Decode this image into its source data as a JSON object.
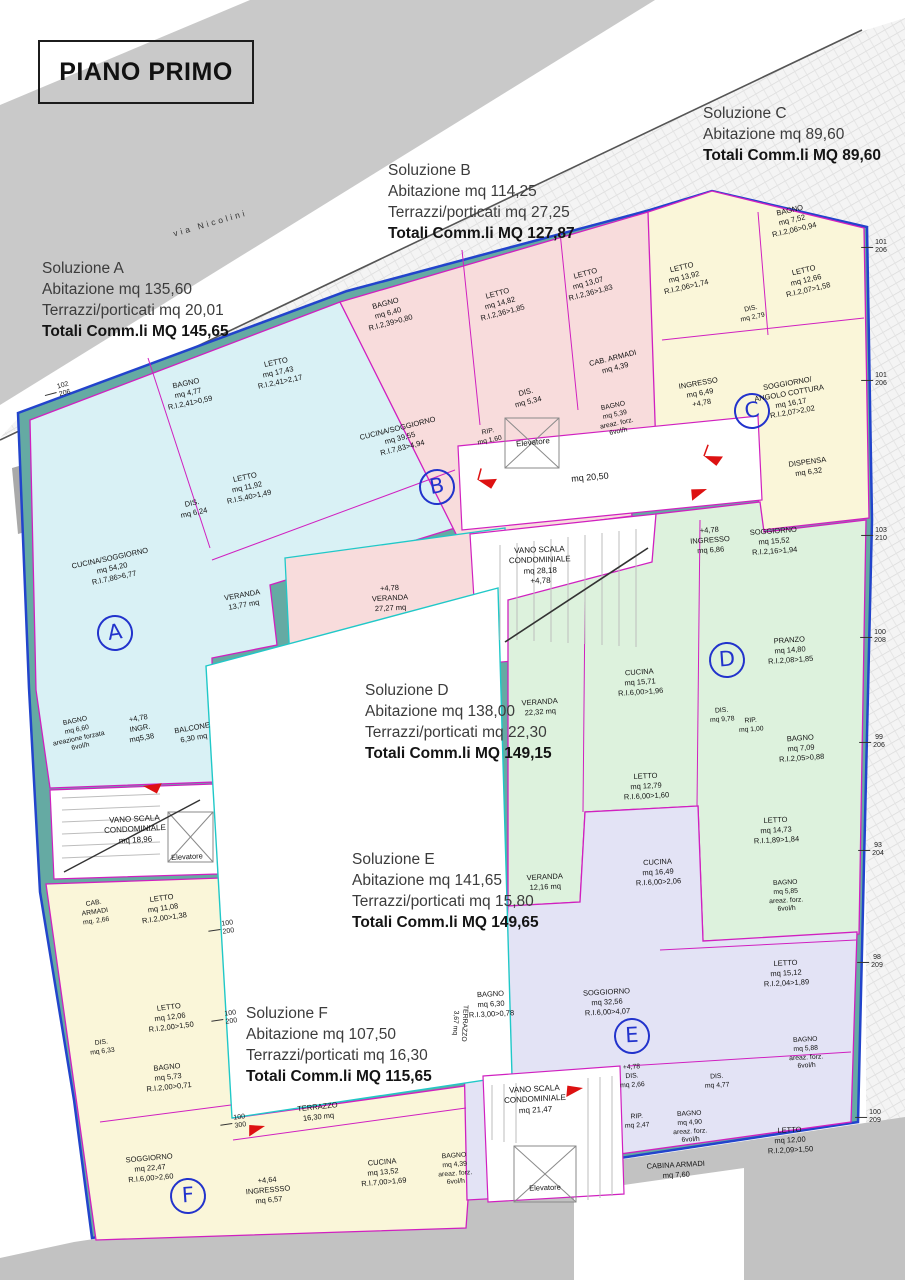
{
  "title": "PIANO PRIMO",
  "street_label": "via Nicolini",
  "solutions": [
    {
      "id": "A",
      "name": "Soluzione A",
      "abitazione": "Abitazione mq 135,60",
      "terrazzi": "Terrazzi/porticati mq 20,01",
      "totale": "Totali Comm.li MQ 145,65"
    },
    {
      "id": "B",
      "name": "Soluzione B",
      "abitazione": "Abitazione mq 114,25",
      "terrazzi": "Terrazzi/porticati mq 27,25",
      "totale": "Totali Comm.li MQ 127,87"
    },
    {
      "id": "C",
      "name": "Soluzione C",
      "abitazione": "Abitazione mq 89,60",
      "terrazzi": "",
      "totale": "Totali Comm.li MQ 89,60"
    },
    {
      "id": "D",
      "name": "Soluzione D",
      "abitazione": "Abitazione mq 138,00",
      "terrazzi": "Terrazzi/porticati mq 22,30",
      "totale": "Totali Comm.li MQ 149,15"
    },
    {
      "id": "E",
      "name": "Soluzione E",
      "abitazione": "Abitazione mq 141,65",
      "terrazzi": "Terrazzi/porticati mq 15,80",
      "totale": "Totali Comm.li MQ 149,65"
    },
    {
      "id": "F",
      "name": "Soluzione F",
      "abitazione": "Abitazione mq 107,50",
      "terrazzi": "Terrazzi/porticati mq 16,30",
      "totale": "Totali Comm.li MQ 115,65"
    }
  ],
  "units": {
    "A": {
      "badge": "A",
      "rooms": {
        "bagno1": "BAGNO\nmq 4,77\nR.I.2,41>0,59",
        "letto1": "LETTO\nmq 17,43\nR.I.2,41>2,17",
        "letto2": "LETTO\nmq 11,92\nR.I.5,40>1,49",
        "dis": "DIS.\nmq 6,24",
        "cucina_soggiorno": "CUCINA/SOGGIORNO\nmq 54,20\nR.I.7,86>6,77",
        "veranda": "VERANDA\n13,77 mq",
        "bagno2": "BAGNO\nmq 6,60\nareazione forzata\n6vol/h",
        "ingresso": "+4,78\nINGR.\nmq5,38",
        "balcone": "BALCONE\n6,30 mq"
      }
    },
    "B": {
      "badge": "B",
      "rooms": {
        "bagno1": "BAGNO\nmq 6,40\nR.I.2,39>0,80",
        "letto1": "LETTO\nmq 14,82\nR.I.2,36>1,85",
        "letto2": "LETTO\nmq 13,07\nR.I.2,36>1,83",
        "cab_armadi": "CAB. ARMADI\nmq 4,39",
        "dis": "DIS.\nmq 5,34",
        "rip": "RIP.\nmq 1,60",
        "bagno2": "BAGNO\nmq 5,39\nareaz. forz.\n6vol/h",
        "cucina_soggiorno": "CUCINA/SOGGIORNO\nmq 39,55\nR.I.7,83>4,94",
        "veranda": "+4,78\nVERANDA\n27,27 mq"
      }
    },
    "C": {
      "badge": "C",
      "rooms": {
        "bagno1": "BAGNO\nmq 7,52\nR.I.2,06>0,94",
        "letto1": "LETTO\nmq 13,92\nR.I.2,06>1,74",
        "letto2": "LETTO\nmq 12,66\nR.I.2,07>1,58",
        "dis": "DIS.\nmq 2,79",
        "ingresso": "INGRESSO\nmq 6,49\n+4,78",
        "soggiorno": "SOGGIORNO/\nANGOLO COTTURA\nmq 16,17\nR.I.2,07>2,02",
        "dispensa": "DISPENSA\nmq 6,32"
      }
    },
    "D": {
      "badge": "D",
      "rooms": {
        "ingresso": "+4,78\nINGRESSO\nmq 6,86",
        "soggiorno": "SOGGIORNO\nmq 15,52\nR.I.2,16>1,94",
        "pranzo": "PRANZO\nmq 14,80\nR.I.2,08>1,85",
        "cucina": "CUCINA\nmq 15,71\nR.I.6,00>1,96",
        "veranda": "VERANDA\n22,32 mq",
        "dis": "DIS.\nmq 9,78",
        "rip": "RIP.\nmq 1,00",
        "bagno1": "BAGNO\nmq 7,09\nR.I.2,05>0,88",
        "letto1": "LETTO\nmq 12,79\nR.I.6,00>1,60",
        "letto2": "LETTO\nmq 14,73\nR.I.1,89>1,84",
        "bagno2": "BAGNO\nmq 5,85\nareaz. forz.\n6vol/h"
      }
    },
    "E": {
      "badge": "E",
      "rooms": {
        "cucina": "CUCINA\nmq 16,49\nR.I.6,00>2,06",
        "veranda": "VERANDA\n12,16 mq",
        "letto1": "LETTO\nmq 15,12\nR.I.2,04>1,89",
        "bagno1": "BAGNO\nmq 6,30\nR.I.3,00>0,78",
        "soggiorno": "SOGGIORNO\nmq 32,56\nR.I.6,00>4,07",
        "terrazzo": "TERRAZZO\n3,67 mq",
        "dis1": "+4,78\nDIS.\nmq 2,66",
        "dis2": "DIS.\nmq 4,77",
        "bagno2": "BAGNO\nmq 5,88\nareaz. forz.\n6vol/h",
        "rip": "RIP.\nmq 2,47",
        "bagno3": "BAGNO\nmq 4,90\nareaz. forz.\n6vol/h",
        "cabina_armadi": "CABINA ARMADI\nmq 7,60",
        "letto2": "LETTO\nmq 12,00\nR.I.2,09>1,50"
      }
    },
    "F": {
      "badge": "F",
      "rooms": {
        "cab_armadi": "CAB.\nARMADI\nmq. 2,66",
        "letto1": "LETTO\nmq 11,08\nR.I.2,00>1,38",
        "letto2": "LETTO\nmq 12,06\nR.I.2,00>1,50",
        "dis": "DIS.\nmq 6,33",
        "bagno1": "BAGNO\nmq 5,73\nR.I.2,00>0,71",
        "soggiorno": "SOGGIORNO\nmq 22,47\nR.I.6,00>2,60",
        "terrazzo": "TERRAZZO\n16,30 mq",
        "ingresso": "+4,64\nINGRESSSO\nmq 6,57",
        "cucina": "CUCINA\nmq 13,52\nR.I.7,00>1,69",
        "bagno2": "BAGNO\nmq 4,39\nareaz. forz.\n6vol/h"
      }
    }
  },
  "common": {
    "elevatore_top": "Elevatore",
    "corridoio": "mq 20,50",
    "vano_scala_centro": "VANO SCALA\nCONDOMINIALE\nmq 28,18\n+4,78",
    "vano_scala_sx": "VANO SCALA\nCONDOMINIALE\nmq 18,96",
    "elevatore_sx": "Elevatore",
    "vano_scala_sud": "VANO SCALA\nCONDOMINIALE\nmq 21,47",
    "elevatore_sud": "Elevatore"
  },
  "markers": {
    "right": [
      "101\n206",
      "101\n206",
      "103\n210",
      "100\n208",
      "99\n206",
      "93\n204",
      "98\n209",
      "100\n209"
    ],
    "left": [
      "102\n206"
    ],
    "inner": [
      "100\n200",
      "100\n200",
      "100\n300"
    ]
  },
  "colors": {
    "wall": "#65aaa3",
    "outline": "#2244cc",
    "partition": "#d020c0",
    "unit_a": "#d9f1f5",
    "unit_b": "#f8dcdc",
    "unit_c": "#faf6d9",
    "unit_d": "#ddf2dd",
    "unit_e": "#e3e3f5",
    "unit_f": "#faf6d9",
    "street": "#c9c9c9",
    "dim": "#e03030",
    "badge": "#2233cc"
  }
}
